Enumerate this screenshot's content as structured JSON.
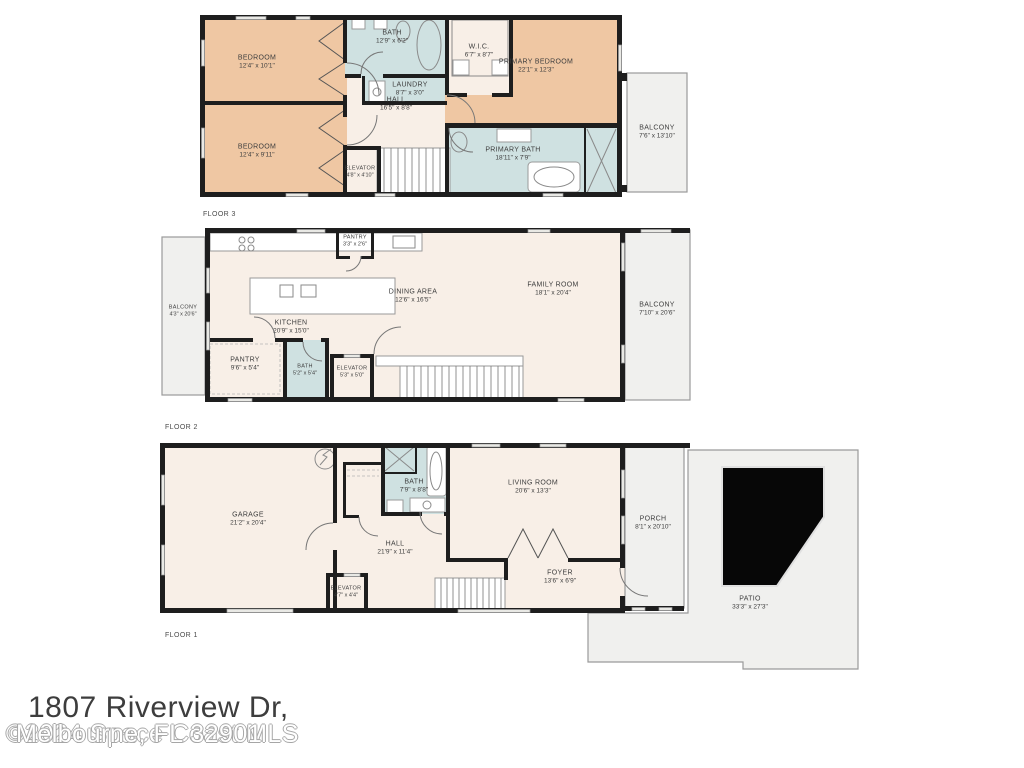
{
  "footer": {
    "address": "1807 Riverview Dr,",
    "watermark_city": "Melbourne, FL 32901",
    "watermark_mls": "©2024 Space Coast MLS"
  },
  "colors": {
    "wall": "#1e1e1e",
    "room_fill": "#f8efe7",
    "bedroom_fill": "#efc7a3",
    "bath_fill": "#cfe1e1",
    "outdoor_fill": "#f0f0ee",
    "label_text": "#3e3e3e"
  },
  "floors": [
    {
      "label": "FLOOR 3",
      "rooms": [
        {
          "name": "BEDROOM",
          "dims": "12'4\" x 10'1\""
        },
        {
          "name": "BEDROOM",
          "dims": "12'4\" x 9'11\""
        },
        {
          "name": "BATH",
          "dims": "12'9\" x 6'2\""
        },
        {
          "name": "LAUNDRY",
          "dims": "8'7\" x 3'0\""
        },
        {
          "name": "W.I.C.",
          "dims": "6'7\" x 8'7\""
        },
        {
          "name": "PRIMARY BEDROOM",
          "dims": "22'1\" x 12'3\""
        },
        {
          "name": "HALL",
          "dims": "16'5\" x 8'8\""
        },
        {
          "name": "ELEVATOR",
          "dims": "4'8\" x 4'10\""
        },
        {
          "name": "PRIMARY BATH",
          "dims": "18'11\" x 7'9\""
        },
        {
          "name": "BALCONY",
          "dims": "7'6\" x 13'10\""
        }
      ]
    },
    {
      "label": "FLOOR 2",
      "rooms": [
        {
          "name": "BALCONY",
          "dims": "4'3\" x 20'6\""
        },
        {
          "name": "KITCHEN",
          "dims": "20'9\" x 15'0\""
        },
        {
          "name": "PANTRY",
          "dims": "3'3\" x 2'6\""
        },
        {
          "name": "DINING AREA",
          "dims": "12'6\" x 16'5\""
        },
        {
          "name": "FAMILY ROOM",
          "dims": "18'1\" x 20'4\""
        },
        {
          "name": "PANTRY",
          "dims": "9'6\" x 5'4\""
        },
        {
          "name": "BATH",
          "dims": "5'2\" x 5'4\""
        },
        {
          "name": "ELEVATOR",
          "dims": "5'3\" x 5'0\""
        },
        {
          "name": "BALCONY",
          "dims": "7'10\" x 20'6\""
        }
      ]
    },
    {
      "label": "FLOOR 1",
      "rooms": [
        {
          "name": "GARAGE",
          "dims": "21'2\" x 20'4\""
        },
        {
          "name": "BATH",
          "dims": "7'9\" x 8'8\""
        },
        {
          "name": "LIVING ROOM",
          "dims": "20'6\" x 13'3\""
        },
        {
          "name": "HALL",
          "dims": "21'9\" x 11'4\""
        },
        {
          "name": "ELEVATOR",
          "dims": "4'7\" x 4'4\""
        },
        {
          "name": "FOYER",
          "dims": "13'6\" x 6'9\""
        },
        {
          "name": "PORCH",
          "dims": "8'1\" x 20'10\""
        },
        {
          "name": "PATIO",
          "dims": "33'3\" x 27'3\""
        }
      ]
    }
  ]
}
